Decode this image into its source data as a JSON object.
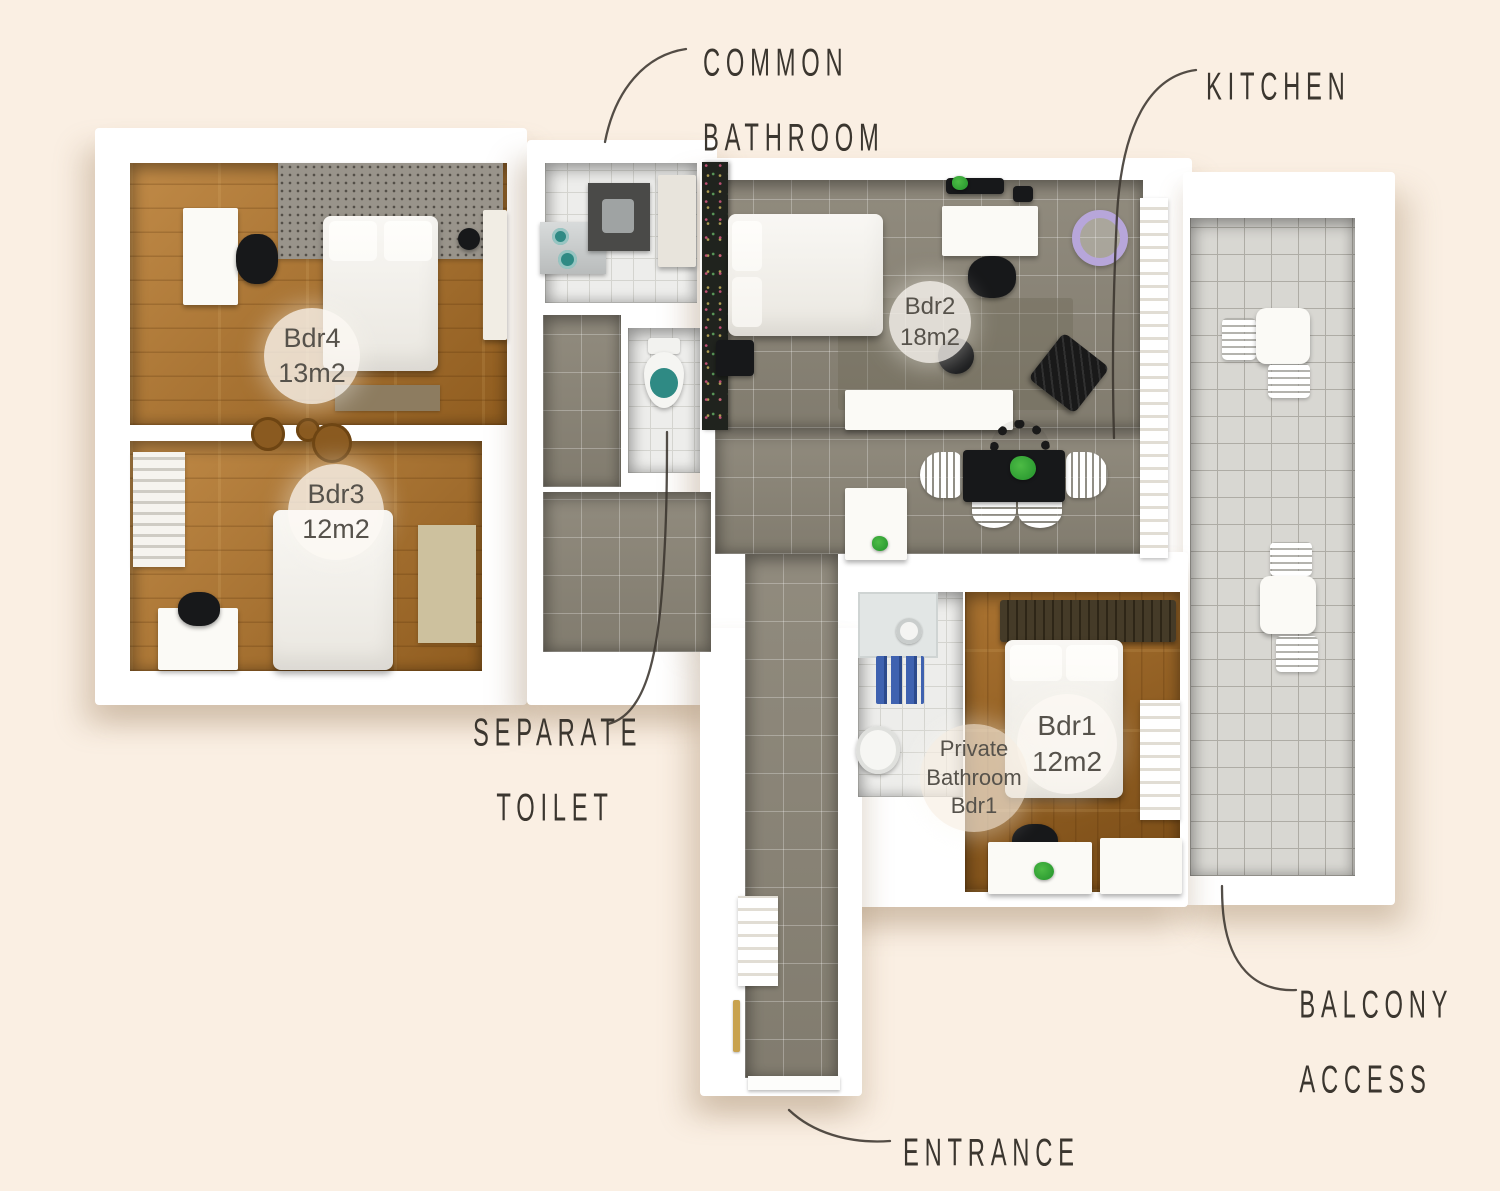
{
  "canvas": {
    "width": 1500,
    "height": 1179
  },
  "colors": {
    "background": "#faefe3",
    "ink": "#3b362f",
    "wall": "#ffffff",
    "badge_bg": "rgba(252,249,243,0.78)",
    "badge_bg_warm": "rgba(247,238,226,0.66)",
    "badge_text": "#56524b",
    "wood_a": "#c08a47",
    "wood_b": "#8f5c1f",
    "wood1_a": "#aa7331",
    "wood1_b": "#774a15",
    "tile_gray": "#8b8577",
    "tile_gray_line": "rgba(255,255,255,0.28)",
    "tile_light": "#d8d7d2",
    "tile_light_line": "#aeaca5",
    "tile_white": "#ededeb",
    "tile_white_line": "#d4d4cf",
    "teal": "#2f8a84",
    "towel_blue": "#3f62b0",
    "plant_green": "#2f9e33",
    "lavender": "#b7a6da",
    "dark": "#17181a",
    "rug_dotted": "#99948b",
    "rug_beige": "#cdc19e",
    "rug_brown": "#8d7c60",
    "gold": "#c8a24e"
  },
  "annotations": {
    "common_bathroom": {
      "line1": "COMMON",
      "line2": "BATHROOM"
    },
    "kitchen": {
      "line1": "KITCHEN"
    },
    "separate_toilet": {
      "line1": "SEPARATE",
      "line2": "TOILET"
    },
    "balcony_access": {
      "line1": "BALCONY",
      "line2": "ACCESS"
    },
    "entrance": {
      "line1": "ENTRANCE"
    }
  },
  "badges": {
    "bdr4": {
      "name": "Bdr4",
      "area": "13m2"
    },
    "bdr3": {
      "name": "Bdr3",
      "area": "12m2"
    },
    "bdr2": {
      "name": "Bdr2",
      "area": "18m2"
    },
    "bdr1": {
      "name": "Bdr1",
      "area": "12m2"
    },
    "private_bathroom": {
      "line1": "Private",
      "line2": "Bathroom",
      "line3": "Bdr1"
    }
  }
}
